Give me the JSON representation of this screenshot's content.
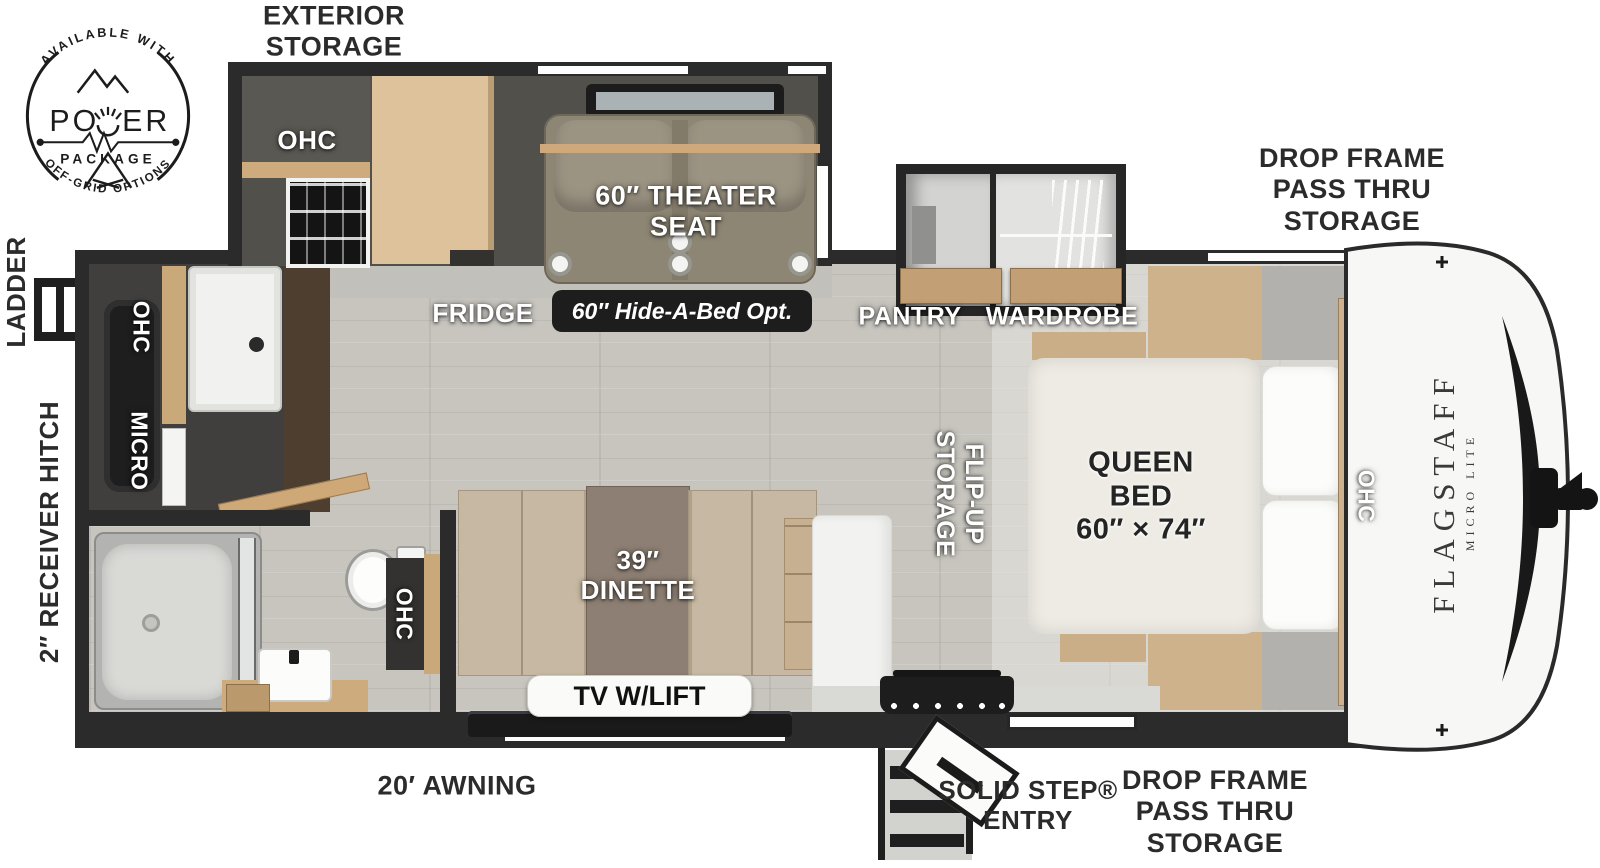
{
  "badge": {
    "arc_top": "AVAILABLE WITH",
    "power": "POWER",
    "package": "PACKAGE",
    "arc_bottom": "OFF-GRID OPTIONS"
  },
  "branding": {
    "name": "FLAGSTAFF",
    "series": "MICRO LITE"
  },
  "labels": {
    "exterior_storage": "EXTERIOR\nSTORAGE",
    "drop_frame_top": "DROP FRAME\nPASS THRU\nSTORAGE",
    "drop_frame_bottom": "DROP FRAME\nPASS THRU\nSTORAGE",
    "ladder": "LADDER",
    "receiver_hitch": "2″ RECEIVER HITCH",
    "ohc_exterior": "OHC",
    "theater_seat": "60″ THEATER\nSEAT",
    "fridge": "FRIDGE",
    "hide_a_bed": "60″ Hide-A-Bed Opt.",
    "pantry": "PANTRY",
    "wardrobe": "WARDROBE",
    "flip_up_storage": "FLIP-UP\nSTORAGE",
    "queen_bed": "QUEEN\nBED\n60″ × 74″",
    "ohc_bed": "OHC",
    "ohc_rear": "OHC",
    "micro": "MICRO",
    "ohc_bath": "OHC",
    "dinette": "39″\nDINETTE",
    "tv_lift": "TV W/LIFT",
    "awning": "20′ AWNING",
    "solid_step_entry": "SOLID STEP®\nENTRY"
  },
  "colors": {
    "wall": "#2b2b2b",
    "floor": "#c7c5be",
    "wood_light": "#dec29b",
    "wood_mid": "#c29f74",
    "seat": "#8e8674",
    "cushion": "#c6b8a2",
    "mattress": "#edebe3",
    "cap_white": "#f7f7f5",
    "pill_black": "#1d1d1d",
    "label_white": "#ffffff",
    "label_dark": "#2b2b2b"
  }
}
